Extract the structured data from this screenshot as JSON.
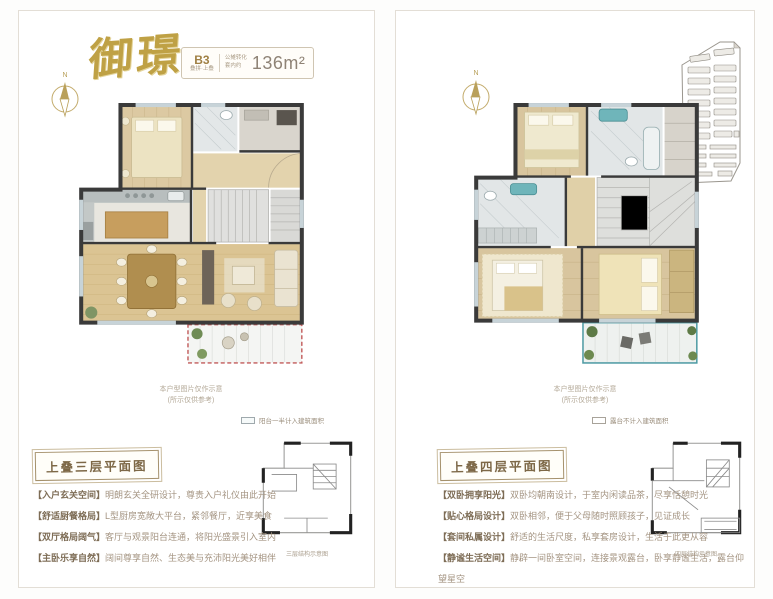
{
  "title": "御璟",
  "compass_label": "N",
  "spec": {
    "unit": "B3",
    "unit_sub": "叠拼·上叠",
    "note_line1": "公摊转化",
    "note_line2": "套内约",
    "area": "136m²"
  },
  "colors": {
    "gold": "#bfa145",
    "wall": "#3a3a3a",
    "balcony_red": "#c25b5b",
    "terrace_teal": "#4d9aa3"
  },
  "left": {
    "floor_label": "上叠三层平面图",
    "legend": "阳台一半计入建筑面积",
    "disclaimer1": "本户型图片仅作示意",
    "disclaimer2": "(所示仅供参考)",
    "keyplan_caption": "三层结构示意图",
    "features": [
      {
        "tag": "【入户玄关空间】",
        "desc": "明朗玄关全研设计，尊贵入户礼仪由此开始"
      },
      {
        "tag": "【舒适厨餐格局】",
        "desc": "L型厨房宽敞大平台，紧邻餐厅，近享美食"
      },
      {
        "tag": "【双厅格局阔气】",
        "desc": "客厅与观景阳台连通，将阳光盛景引入室内"
      },
      {
        "tag": "【主卧乐享自然】",
        "desc": "阔间尊享自然、生态美与充沛阳光美好相伴"
      }
    ]
  },
  "right": {
    "floor_label": "上叠四层平面图",
    "legend": "露台不计入建筑面积",
    "disclaimer1": "本户型图片仅作示意",
    "disclaimer2": "(所示仅供参考)",
    "keyplan_caption": "四层结构示意图",
    "features": [
      {
        "tag": "【双卧拥享阳光】",
        "desc": "双卧均朝南设计，于室内闲读品茶，尽享恬憩时光"
      },
      {
        "tag": "【贴心格局设计】",
        "desc": "双卧相邻，便于父母随时照顾孩子，见证成长"
      },
      {
        "tag": "【套间私属设计】",
        "desc": "舒适的生活尺度，私享套房设计，生活于此更从容"
      },
      {
        "tag": "【静谧生活空间】",
        "desc": "静辟一间卧室空间，连接景观露台，卧享静谧生活，露台仰望星空"
      }
    ]
  }
}
